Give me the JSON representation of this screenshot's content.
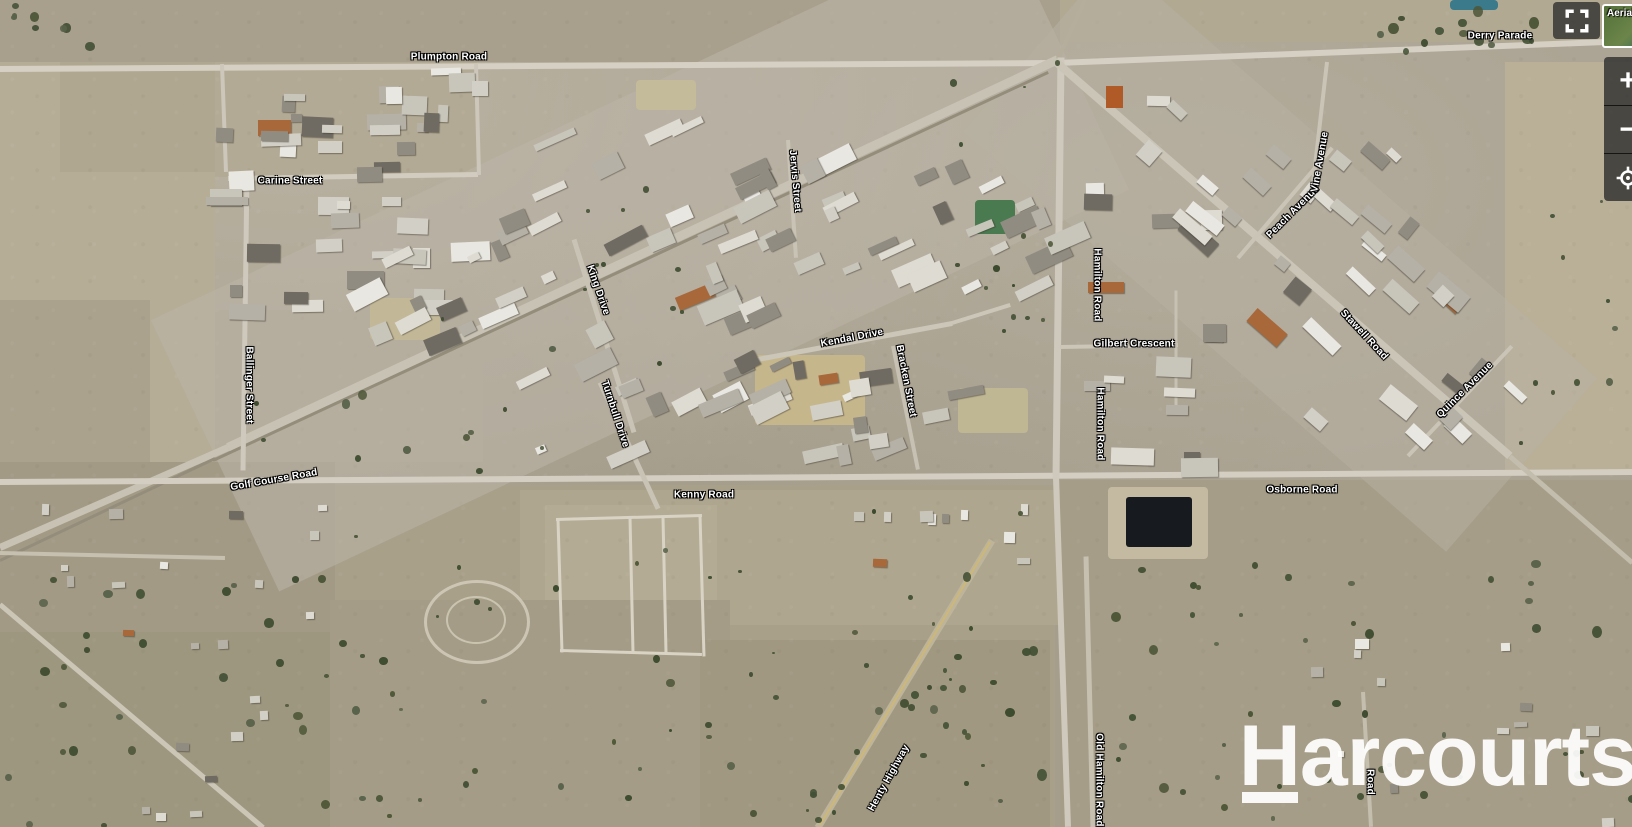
{
  "map": {
    "watermark": "Harcourts",
    "type_label": "Aerial"
  },
  "controls": {
    "zoom_in": "+",
    "zoom_out": "−"
  },
  "road_labels": [
    {
      "text": "Plumpton Road",
      "x": 449,
      "y": 57,
      "rot": 0
    },
    {
      "text": "Derry Parade",
      "x": 1500,
      "y": 36,
      "rot": 0
    },
    {
      "text": "Carine Street",
      "x": 290,
      "y": 181,
      "rot": 0
    },
    {
      "text": "Jervis Street",
      "x": 795,
      "y": 181,
      "rot": 85
    },
    {
      "text": "King Drive",
      "x": 598,
      "y": 290,
      "rot": 71
    },
    {
      "text": "Turnbull Drive",
      "x": 615,
      "y": 414,
      "rot": 72
    },
    {
      "text": "Kendal Drive",
      "x": 852,
      "y": 338,
      "rot": -11
    },
    {
      "text": "Bracken Street",
      "x": 906,
      "y": 381,
      "rot": 79
    },
    {
      "text": "Ballinger Street",
      "x": 249,
      "y": 385,
      "rot": 90
    },
    {
      "text": "Hamilton Road",
      "x": 1097,
      "y": 285,
      "rot": 90
    },
    {
      "text": "Gilbert Crescent",
      "x": 1134,
      "y": 344,
      "rot": 0
    },
    {
      "text": "Hamilton Road",
      "x": 1100,
      "y": 424,
      "rot": 90
    },
    {
      "text": "Peach Avenue",
      "x": 1293,
      "y": 212,
      "rot": -45
    },
    {
      "text": "Vine Avenue",
      "x": 1320,
      "y": 162,
      "rot": -80
    },
    {
      "text": "Stawell Road",
      "x": 1364,
      "y": 335,
      "rot": 47
    },
    {
      "text": "Quince Avenue",
      "x": 1465,
      "y": 390,
      "rot": -45
    },
    {
      "text": "Golf Course Road",
      "x": 274,
      "y": 480,
      "rot": -10
    },
    {
      "text": "Kenny Road",
      "x": 704,
      "y": 495,
      "rot": 0
    },
    {
      "text": "Osborne Road",
      "x": 1302,
      "y": 490,
      "rot": 0
    },
    {
      "text": "Henty Highway",
      "x": 889,
      "y": 778,
      "rot": -61
    },
    {
      "text": "Old Hamilton Road",
      "x": 1099,
      "y": 780,
      "rot": 90
    },
    {
      "text": "Road",
      "x": 1370,
      "y": 782,
      "rot": 90
    }
  ]
}
